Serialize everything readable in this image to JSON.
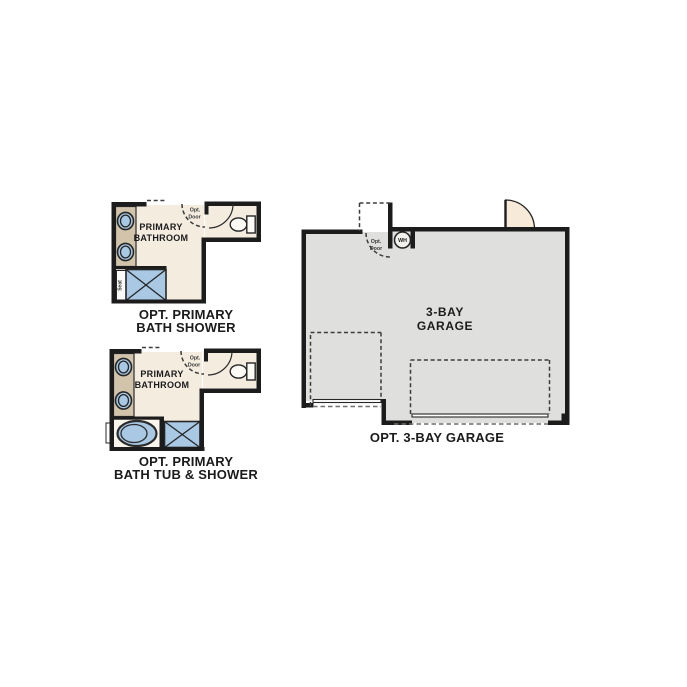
{
  "colors": {
    "wall": "#1c1c1c",
    "bathroom_floor": "#f3ecdf",
    "counter_tan": "#d2c3ab",
    "fixture_blue": "#a8c8e3",
    "tub_room_floor": "#f8f5ec",
    "garage_floor": "#dfdfdd",
    "door_swing": "#f7ead9",
    "porcelain": "#fbfaf5",
    "water_heater_fill": "#f2f1ed"
  },
  "plan_bath_shower": {
    "room_label": [
      "PRIMARY",
      "BATHROOM"
    ],
    "opt_door_label": [
      "Opt.",
      "Door"
    ],
    "seat_label": "Seat",
    "caption": [
      "OPT. PRIMARY",
      "BATH SHOWER"
    ]
  },
  "plan_bath_tub_shower": {
    "room_label": [
      "PRIMARY",
      "BATHROOM"
    ],
    "opt_door_label": [
      "Opt.",
      "Door"
    ],
    "caption": [
      "OPT. PRIMARY",
      "BATH TUB & SHOWER"
    ]
  },
  "plan_garage": {
    "room_label": [
      "3-BAY",
      "GARAGE"
    ],
    "opt_door_label": [
      "Opt.",
      "Door"
    ],
    "water_heater_label": "WH",
    "caption": "OPT. 3-BAY GARAGE"
  }
}
